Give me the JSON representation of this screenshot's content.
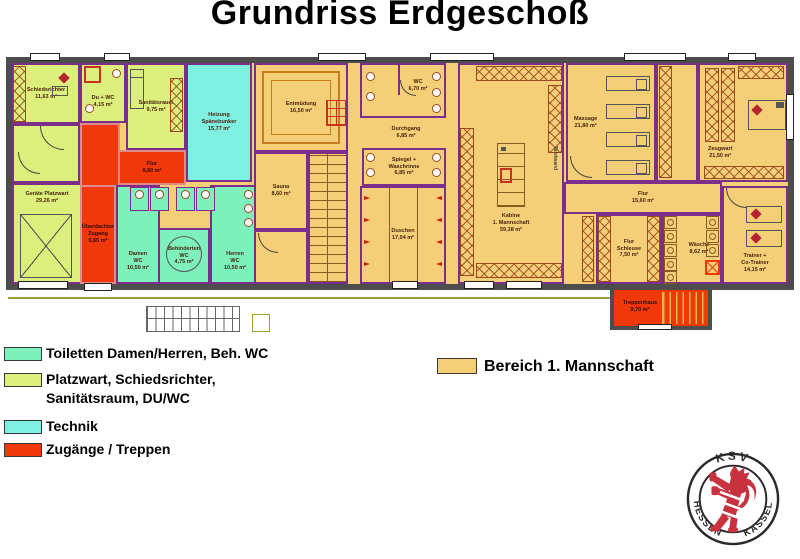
{
  "title": "Grundriss Erdgeschoß",
  "colors": {
    "wall": "#4D4D4D",
    "interior_wall": "#7B2F8B",
    "toiletten": "#7DF0BC",
    "platzwart": "#DCEF7C",
    "technik": "#7FF0E0",
    "zugaenge": "#F1380A",
    "mannschaft": "#F5CF77",
    "furniture": "#9B4A1E",
    "lion_red": "#C8323F"
  },
  "legend": {
    "items": [
      {
        "label": "Toiletten Damen/Herren, Beh. WC",
        "color": "#7DF0BC"
      },
      {
        "label": "Platzwart, Schiedsrichter,\nSanitätsraum, DU/WC",
        "color": "#DCEF7C"
      },
      {
        "label": "Technik",
        "color": "#7FF0E0"
      },
      {
        "label": "Zugänge / Treppen",
        "color": "#F1380A"
      }
    ],
    "area_item": {
      "label": "Bereich 1. Mannschaft",
      "color": "#F5CF77"
    }
  },
  "plan": {
    "rooms": [
      {
        "id": "schiedsrichter",
        "label": "Schiedsrichter\n11,63 m²"
      },
      {
        "id": "du-wc",
        "label": "Du + WC\n4,15 m²"
      },
      {
        "id": "sanitaetsraum",
        "label": "Sanitätsraum\n9,75 m²"
      },
      {
        "id": "geraete-platzwart",
        "label": "Geräte Platzwart\n29,26 m²"
      },
      {
        "id": "flur-links",
        "label": "Flur\n9,60 m²"
      },
      {
        "id": "ueberdachter-zugang",
        "label": "Überdachter\nZugang\n5,65 m²"
      },
      {
        "id": "heizung",
        "label": "Heizung\nSpänebunker\n15,77 m²"
      },
      {
        "id": "damen-wc",
        "label": "Damen\nWC\n10,50 m²"
      },
      {
        "id": "behinderten-wc",
        "label": "Behinderten\nWC\n4,75 m²"
      },
      {
        "id": "herren-wc",
        "label": "Herren\nWC\n10,50 m²"
      },
      {
        "id": "entmuedung",
        "label": "Entmüdung\n16,50 m²"
      },
      {
        "id": "sauna",
        "label": "Sauna\n8,60 m²"
      },
      {
        "id": "wc-mitte",
        "label": "WC\n6,70 m²"
      },
      {
        "id": "durchgang",
        "label": "Durchgang\n6,85 m²"
      },
      {
        "id": "spiegel-waschrinne",
        "label": "Spiegel +\nWaschrinne\n6,85 m²"
      },
      {
        "id": "duschen",
        "label": "Duschen\n17,04 m²"
      },
      {
        "id": "kabine-1-mannschaft",
        "label": "Kabine\n1. Mannschaft\n59,38 m²"
      },
      {
        "id": "massage",
        "label": "Massage\n21,80 m²"
      },
      {
        "id": "zeugwart",
        "label": "Zeugwart\n21,50 m²"
      },
      {
        "id": "flur-rechts",
        "label": "Flur\n15,60 m²"
      },
      {
        "id": "flur-schleuse",
        "label": "Flur\nSchleuse\n7,50 m²"
      },
      {
        "id": "waesche",
        "label": "Wäsche\n8,62 m²"
      },
      {
        "id": "trainer-co-trainer",
        "label": "Trainer +\nCo-Trainer\n14,15 m²"
      },
      {
        "id": "treppenhaus",
        "label": "Treppenhaus\n9,70 m²"
      }
    ],
    "annotations": {
      "tafelwand": "Tafelwand"
    }
  },
  "logo": {
    "top": "KSV",
    "bottom_left": "HESSEN",
    "bottom_right": "KASSEL"
  }
}
